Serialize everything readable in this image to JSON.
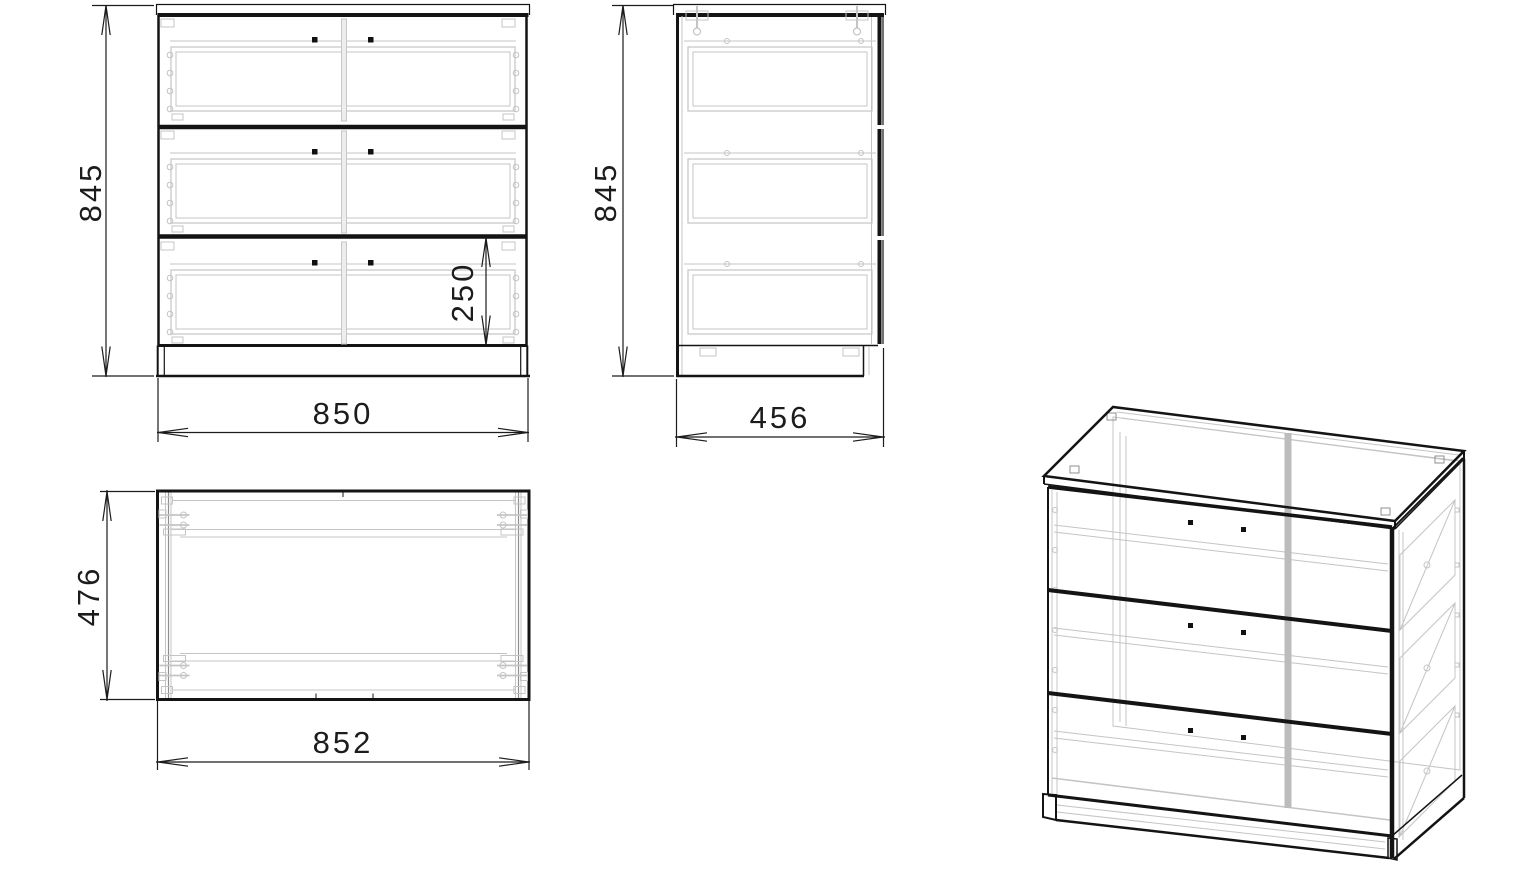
{
  "dimensions": {
    "front_height": "845",
    "front_width": "850",
    "bottom_drawer_front_height": "250",
    "side_height": "845",
    "side_depth": "456",
    "top_depth": "476",
    "top_width": "852"
  },
  "colors": {
    "line": "#141414",
    "hidden_detail": "#c4c4c4",
    "background": "#ffffff"
  }
}
